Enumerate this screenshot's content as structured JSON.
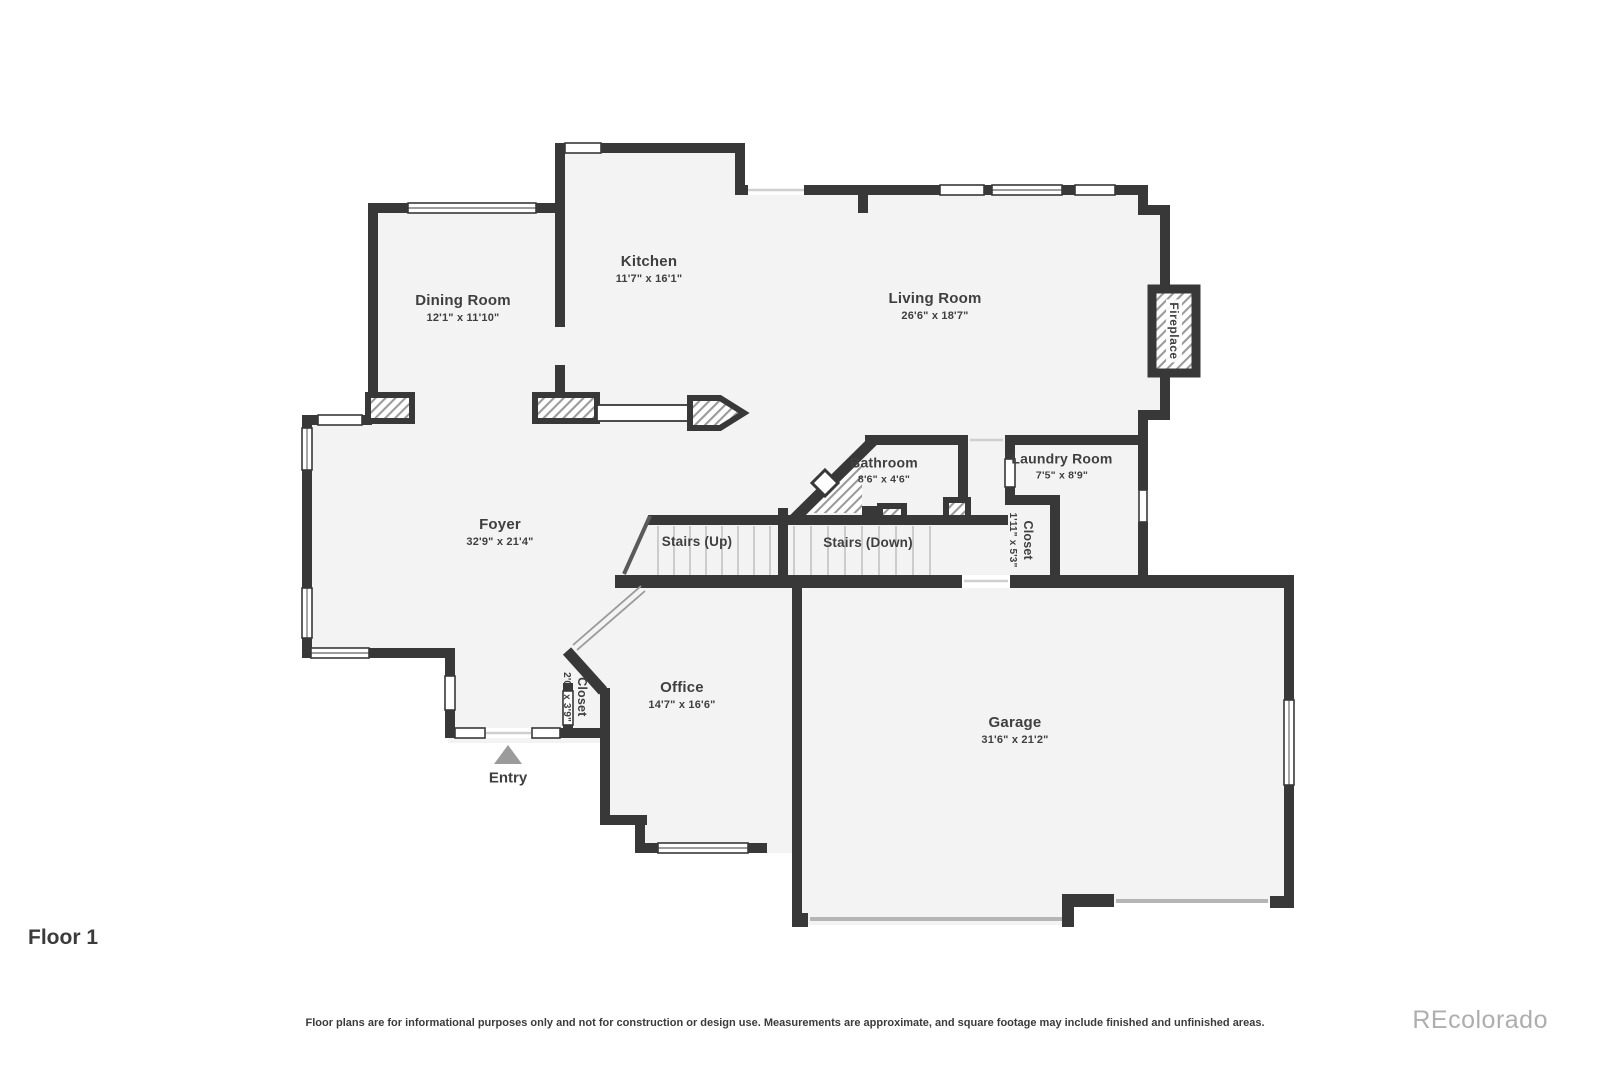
{
  "page": {
    "floor_label": "Floor 1",
    "disclaimer": "Floor plans are for informational purposes only and not for construction or design use. Measurements are approximate, and square footage may include finished and unfinished areas.",
    "watermark": "REcolorado"
  },
  "colors": {
    "wall": "#383838",
    "floor": "#f3f3f3",
    "text": "#3f3f3f",
    "entry_marker": "#9b9b9b",
    "watermark": "#aeaeae"
  },
  "rooms": {
    "dining": {
      "name": "Dining Room",
      "dims": "12'1\" x 11'10\""
    },
    "kitchen": {
      "name": "Kitchen",
      "dims": "11'7\" x 16'1\""
    },
    "living": {
      "name": "Living Room",
      "dims": "26'6\" x 18'7\""
    },
    "foyer": {
      "name": "Foyer",
      "dims": "32'9\" x 21'4\""
    },
    "bathroom": {
      "name": "Bathroom",
      "dims": "8'6\" x 4'6\""
    },
    "laundry": {
      "name": "Laundry Room",
      "dims": "7'5\" x 8'9\""
    },
    "office": {
      "name": "Office",
      "dims": "14'7\" x 16'6\""
    },
    "garage": {
      "name": "Garage",
      "dims": "31'6\" x 21'2\""
    },
    "closet_laundry": {
      "name": "Closet",
      "dims": "1'11\" x 5'3\""
    },
    "closet_entry": {
      "name": "Closet",
      "dims": "2'0\" x 3'9\""
    }
  },
  "features": {
    "fireplace": "Fireplace",
    "stairs_up": "Stairs (Up)",
    "stairs_down": "Stairs (Down)",
    "entry": "Entry"
  }
}
